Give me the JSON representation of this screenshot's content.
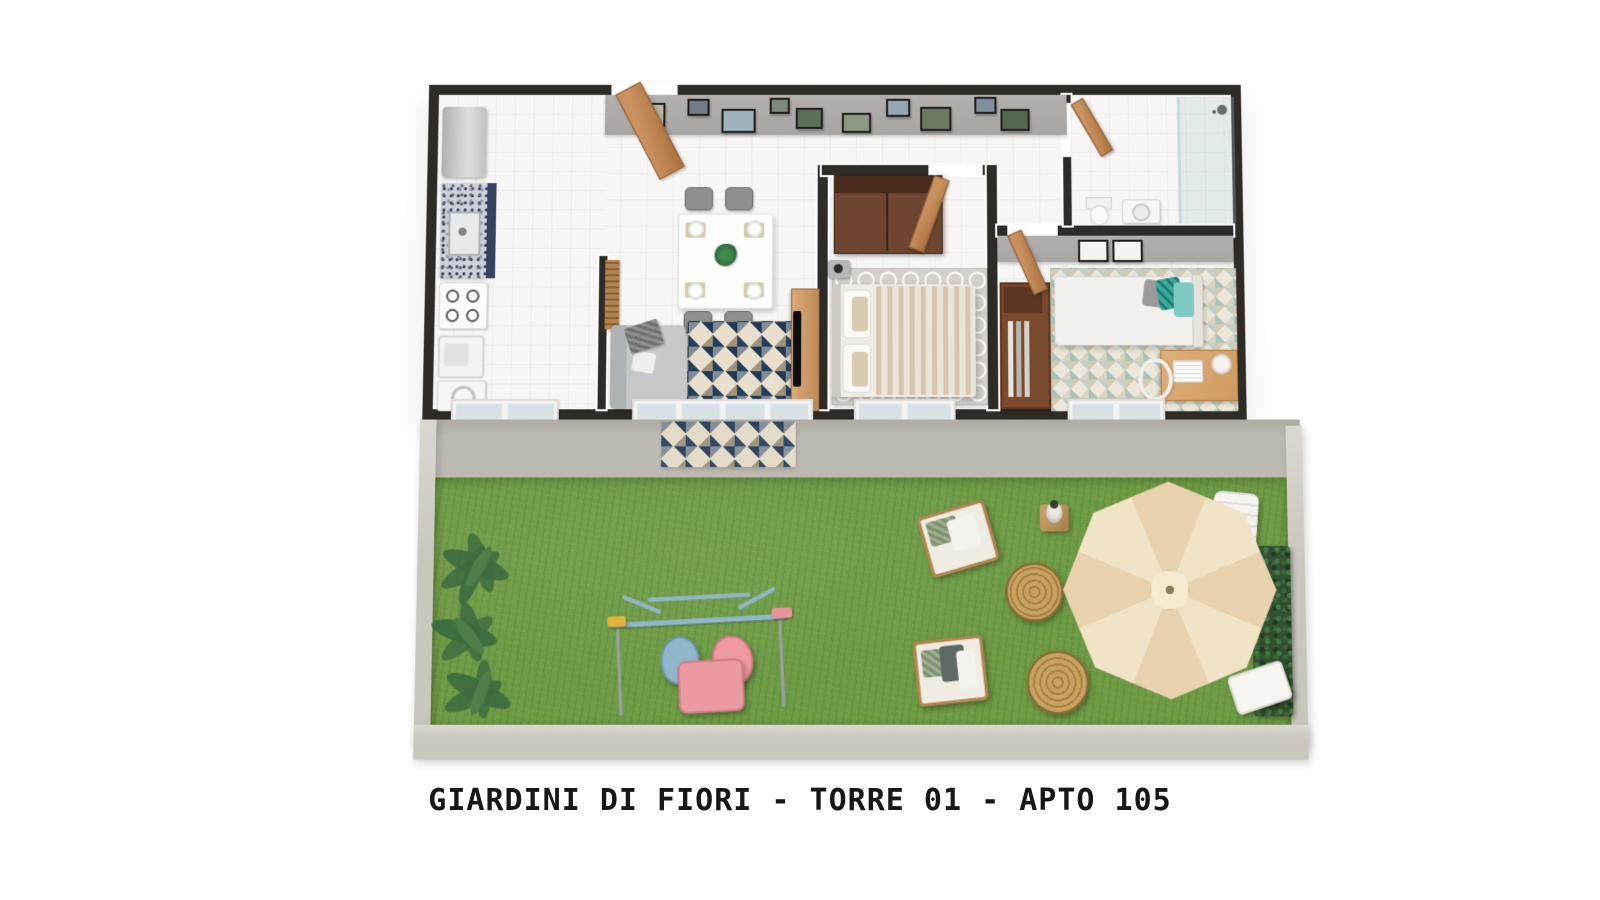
{
  "caption": {
    "text": "GIARDINI DI FIORI - TORRE 01 - APTO 105"
  },
  "project": {
    "name": "GIARDINI DI FIORI",
    "tower": "TORRE 01",
    "unit": "APTO 105"
  },
  "palette": {
    "page": "#ffffff",
    "wall": "#2f2b27",
    "floor": "#f7f6f4",
    "accent-wall": "#a7a4a1",
    "wood": "#c99260",
    "wood-dark": "#a9713c",
    "wardrobe": "#6b4027",
    "counter-navy": "#37425f",
    "rug-beige": "#e8e0cc",
    "rug-navy": "#2e4a6b",
    "teal": "#3aa79d",
    "grass": "#6d9a43",
    "patio": "#bdbab2",
    "garden-wall": "#c9c6bc",
    "umbrella": "#eedcba",
    "swing-pink": "#e8939c",
    "swing-blue": "#8fb6c9",
    "swing-yellow": "#e0b43c",
    "wicker": "#c8a163",
    "hedge": "#30502f"
  }
}
